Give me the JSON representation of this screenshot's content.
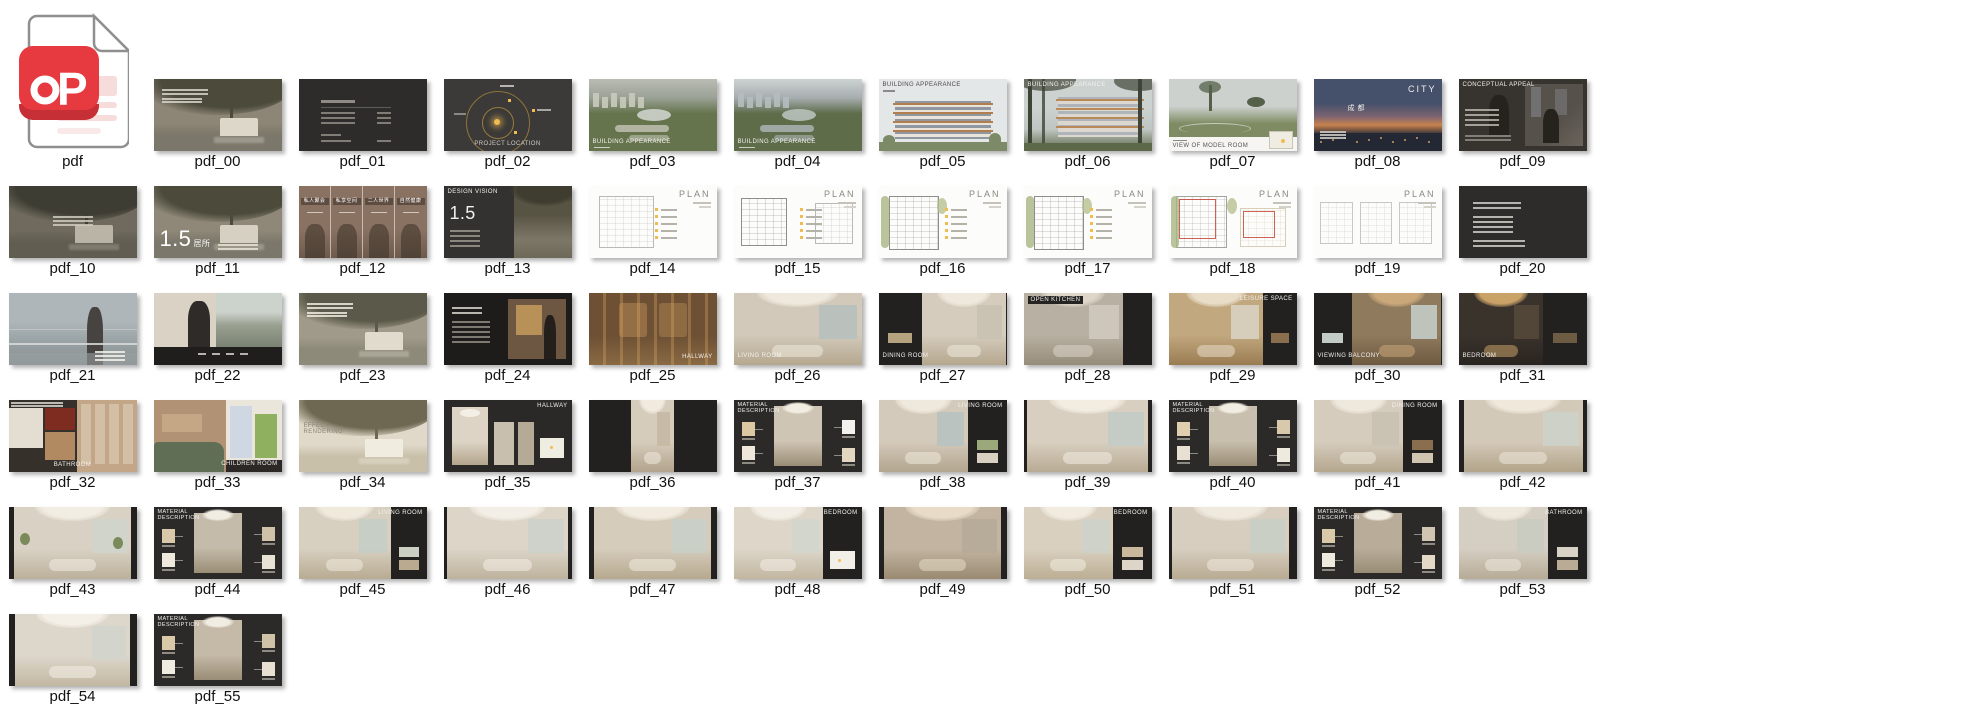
{
  "page": {
    "background": "#ffffff"
  },
  "file_icon": {
    "label": "pdf",
    "glyph": "P",
    "badge_color": "#e63a40",
    "badge_shade": "#c52f35",
    "page_line_color": "#f7dcdc",
    "outline_color": "#8f8f8f"
  },
  "grid": {
    "columns": 11,
    "thumbnails": [
      {
        "label": "pdf_00",
        "kind": "cover",
        "p": {
          "base": "#8d8575",
          "canopy": "#4b4a3b",
          "water": "#7b776a",
          "bld": "#dcd7c9",
          "txt": "#d8d4c8"
        }
      },
      {
        "label": "pdf_01",
        "kind": "toc",
        "variant": "catalog",
        "p": {
          "bg": "#2d2c2b",
          "txt": "#8f8b84"
        }
      },
      {
        "label": "pdf_02",
        "kind": "map",
        "caption": "PROJECT LOCATION",
        "cpos": "bc",
        "ccolor": "#cfccc6",
        "p": {
          "bg": "#3b3a38",
          "ring": "#a5823c",
          "dot": "#f0bc52"
        }
      },
      {
        "label": "pdf_03",
        "kind": "aerial",
        "caption": "BUILDING APPEARANCE",
        "cpos": "bl",
        "p": {
          "sky": "#b9bdb4",
          "far": "#9aa195",
          "green": "#65744d",
          "lake": "#cdd3cb",
          "bld": "#c9cabc"
        }
      },
      {
        "label": "pdf_04",
        "kind": "aerial",
        "caption": "BUILDING APPEARANCE",
        "cpos": "bl",
        "p": {
          "sky": "#cdd3d2",
          "far": "#a8aeb0",
          "green": "#5e6c4a",
          "lake": "#b9c2bd",
          "bld": "#b5bcc0"
        }
      },
      {
        "label": "pdf_05",
        "kind": "elevation",
        "caption": "BUILDING APPEARANCE",
        "cpos": "tl",
        "ccolor": "#4a4a48",
        "p": {
          "sky": "#e4e7e8",
          "bld": "#9097a0",
          "wood": "#b27e4e",
          "green": "#7d8a68"
        }
      },
      {
        "label": "pdf_06",
        "kind": "treesbld",
        "caption": "BUILDING APPEARANCE",
        "cpos": "tl",
        "p": {
          "sky": "#ccd2d0",
          "bld": "#aeb4ba",
          "wood": "#b98a58",
          "tree": "#3f4438",
          "green": "#5c6848"
        }
      },
      {
        "label": "pdf_07",
        "kind": "park",
        "caption": "VIEW OF MODEL ROOM",
        "ccolor": "#55534e",
        "p": {
          "sky": "#ccd1ce",
          "field": "#7f8c63",
          "tree": "#55604a",
          "strip": "#f6f5f2"
        }
      },
      {
        "label": "pdf_08",
        "kind": "dusk",
        "caption": "CITY",
        "cn": "成都",
        "p": {
          "top": "#45506a",
          "mid": "#7c6470",
          "horizon": "#c8824e",
          "land": "#232834"
        }
      },
      {
        "label": "pdf_09",
        "kind": "conceptual",
        "caption": "CONCEPTUAL APPEAL",
        "cpos": "tl",
        "p": {
          "bg": "#37332e",
          "photo": "#56514a",
          "win": "#8d9298"
        }
      },
      {
        "label": "pdf_10",
        "kind": "cover",
        "centered": true,
        "p": {
          "base": "#6f6a5d",
          "canopy": "#3e3d33",
          "water": "#615d51",
          "bld": "#b9b4a5",
          "txt": "#cfcabc"
        }
      },
      {
        "label": "pdf_11",
        "kind": "bignum",
        "big": "1.5",
        "small": "居所",
        "p": {
          "base": "#8f8878",
          "canopy": "#4b4a3b",
          "water": "#7b776a",
          "bld": "#d5d0c2"
        }
      },
      {
        "label": "pdf_12",
        "kind": "people",
        "labels": [
          "私人聚会",
          "私享空间",
          "二人世界",
          "自然健康"
        ],
        "p": {
          "base": "#8a7263",
          "dark": "#3a2f28"
        }
      },
      {
        "label": "pdf_13",
        "kind": "vision",
        "caption": "DESIGN VISION",
        "big": "1.5",
        "p": {
          "left": "#343230",
          "tree": "#585444",
          "base": "#7d7768"
        }
      },
      {
        "label": "pdf_14",
        "kind": "plan",
        "caption": "PLAN",
        "legend": true,
        "plans": [
          {
            "x": 8,
            "y": 14,
            "w": 42,
            "h": 70,
            "c": "#b9b9b6"
          }
        ]
      },
      {
        "label": "pdf_15",
        "kind": "plan",
        "caption": "PLAN",
        "legend": true,
        "plans": [
          {
            "x": 6,
            "y": 16,
            "w": 34,
            "h": 64,
            "c": "#8f8d88"
          },
          {
            "x": 64,
            "y": 24,
            "w": 28,
            "h": 54,
            "c": "#b9b9b6"
          }
        ]
      },
      {
        "label": "pdf_16",
        "kind": "plan",
        "caption": "PLAN",
        "legend": true,
        "green": true,
        "plans": [
          {
            "x": 8,
            "y": 14,
            "w": 38,
            "h": 72,
            "c": "#8f8d88"
          }
        ]
      },
      {
        "label": "pdf_17",
        "kind": "plan",
        "caption": "PLAN",
        "legend": true,
        "green": true,
        "plans": [
          {
            "x": 8,
            "y": 14,
            "w": 38,
            "h": 72,
            "c": "#8f8d88"
          }
        ]
      },
      {
        "label": "pdf_18",
        "kind": "plan",
        "caption": "PLAN",
        "red": true,
        "green": true,
        "plans": [
          {
            "x": 6,
            "y": 14,
            "w": 38,
            "h": 70,
            "c": "#a5a3a0"
          },
          {
            "x": 56,
            "y": 30,
            "w": 34,
            "h": 52,
            "c": "#d9cfb8"
          }
        ]
      },
      {
        "label": "pdf_19",
        "kind": "plan",
        "caption": "PLAN",
        "plans": [
          {
            "x": 5,
            "y": 22,
            "w": 24,
            "h": 56,
            "c": "#c9c7c3"
          },
          {
            "x": 36,
            "y": 22,
            "w": 24,
            "h": 56,
            "c": "#c9c7c3"
          },
          {
            "x": 67,
            "y": 22,
            "w": 24,
            "h": 56,
            "c": "#c9c7c3"
          }
        ]
      },
      {
        "label": "pdf_20",
        "kind": "toc",
        "variant": "notes",
        "p": {
          "bg": "#2d2c2b",
          "txt": "#cfccc6"
        }
      },
      {
        "label": "pdf_21",
        "kind": "balcony",
        "p": {
          "sky": "#aeb6ba",
          "sea": "#97a0a2",
          "fig": "#474340",
          "rail": "#d8dbd8"
        }
      },
      {
        "label": "pdf_22",
        "kind": "suit",
        "p": {
          "l": "#d9d2c5",
          "fig": "#2f2b28",
          "r": "#99a090",
          "sky": "#ccd2cc",
          "strip": "#201e1c"
        }
      },
      {
        "label": "pdf_23",
        "kind": "cover",
        "p": {
          "base": "#a09a8a",
          "canopy": "#5b5949",
          "water": "#8e8a7a",
          "bld": "#e0dbcd",
          "txt": "#efeade"
        }
      },
      {
        "label": "pdf_24",
        "kind": "darkperson",
        "p": {
          "bg": "#1e1c1a",
          "photo": "#6e5742",
          "art": "#c9a05e",
          "fig": "#241f1b"
        }
      },
      {
        "label": "pdf_25",
        "kind": "hallway",
        "caption": "HALLWAY",
        "cpos": "br",
        "p": {
          "base": "#6e5134",
          "slit": "#dca868",
          "floor": "#8a6a44"
        }
      },
      {
        "label": "pdf_26",
        "kind": "room",
        "caption": "LIVING ROOM",
        "cpos": "bl",
        "edges": [
          0,
          0
        ],
        "p": {
          "base": "#d2c9ba",
          "ceil": "#efe9dd",
          "floor": "#b5a890",
          "win": "#b7c0bd"
        }
      },
      {
        "label": "pdf_27",
        "kind": "room",
        "caption": "DINING ROOM",
        "cpos": "bl",
        "edges": [
          34,
          0
        ],
        "chips": [
          "#b5a27e"
        ],
        "p": {
          "base": "#d5ccbd",
          "ceil": "#efe9dd",
          "floor": "#b5a78e",
          "win": "#c9c2b2"
        }
      },
      {
        "label": "pdf_28",
        "kind": "room",
        "caption": "OPEN KITCHEN",
        "cpos": "tl",
        "capbg": "#262422",
        "edges": [
          0,
          22
        ],
        "p": {
          "base": "#b8b0a2",
          "ceil": "#ddd6c9",
          "floor": "#968c7a",
          "win": "#cfc9bc"
        }
      },
      {
        "label": "pdf_29",
        "kind": "room",
        "caption": "LEISURE SPACE",
        "cpos": "tr",
        "edges": [
          0,
          26
        ],
        "chips": [
          "#8a6f4e"
        ],
        "p": {
          "base": "#c2a87f",
          "ceil": "#e9ddc8",
          "floor": "#9a7c52",
          "win": "#d8d2c2"
        }
      },
      {
        "label": "pdf_30",
        "kind": "room",
        "caption": "VIEWING BALCONY",
        "cpos": "bl",
        "edges": [
          30,
          0
        ],
        "chips": [
          "#c3cbc6"
        ],
        "p": {
          "base": "#8f7a5e",
          "ceil": "#caa87a",
          "floor": "#6e5a40",
          "win": "#c3cbc6"
        }
      },
      {
        "label": "pdf_31",
        "kind": "room",
        "caption": "BEDROOM",
        "cpos": "bl",
        "edges": [
          0,
          34
        ],
        "chips": [
          "#6e5b44"
        ],
        "p": {
          "base": "#3a332c",
          "ceil": "#c9a268",
          "floor": "#2a2420",
          "win": "#55483a"
        }
      },
      {
        "label": "pdf_32",
        "kind": "bathcol",
        "caption": "BATHROOM",
        "cpos": "bc",
        "p": {
          "a": "#e3ddd2",
          "red": "#7e2c20",
          "wood": "#b28a62",
          "ward": "#c2a687",
          "dark": "#35302a"
        }
      },
      {
        "label": "pdf_33",
        "kind": "children",
        "caption": "CHILDREN ROOM",
        "cpos": "br",
        "p": {
          "wall": "#b29274",
          "bed": "#5f6e55",
          "panel": "#eae6dc",
          "poster": "#8fb05e",
          "floral": "#cfd8e2"
        }
      },
      {
        "label": "pdf_34",
        "kind": "cover",
        "caption": "EFFECT RENDERING",
        "cpos": "cl",
        "ccolor": "#8a8578",
        "p": {
          "base": "#e0d9c9",
          "canopy": "#6e6852",
          "water": "#c9c0a9",
          "bld": "#f0ece0",
          "txt": "#b5ad9a"
        }
      },
      {
        "label": "pdf_35",
        "kind": "panels",
        "caption": "HALLWAY",
        "cpos": "tr",
        "p": {
          "bg": "#2b2928",
          "p1": "#ddd4c5",
          "p2": "#c9bfae",
          "p3": "#b5aa96"
        }
      },
      {
        "label": "pdf_36",
        "kind": "room",
        "edges": [
          33,
          33
        ],
        "p": {
          "base": "#d6ccbc",
          "ceil": "#f0eadf",
          "floor": "#b2a48c",
          "win": "#c5b9a4"
        }
      },
      {
        "label": "pdf_37",
        "kind": "material",
        "caption": "MATERIAL DESCRIPTION",
        "p": {
          "bg": "#2b2a29",
          "photo": "#cfc5b4",
          "sw": [
            "#dcc9a4",
            "#efe8da",
            "#f4f2ec",
            "#e3d7c2"
          ]
        }
      },
      {
        "label": "pdf_38",
        "kind": "room",
        "caption": "LIVING ROOM",
        "cpos": "tr",
        "edges": [
          0,
          30
        ],
        "chips": [
          "#9aa87a",
          "#d8d0c0"
        ],
        "p": {
          "base": "#d4cabb",
          "ceil": "#efe9dd",
          "floor": "#b3a58e",
          "win": "#b7c2c0"
        }
      },
      {
        "label": "pdf_39",
        "kind": "room",
        "edges": [
          3,
          3
        ],
        "p": {
          "base": "#d8cfc0",
          "ceil": "#f2ece1",
          "floor": "#b9ab94",
          "win": "#c3cbc6"
        }
      },
      {
        "label": "pdf_40",
        "kind": "material",
        "caption": "MATERIAL DESCRIPTION",
        "p": {
          "bg": "#2b2a29",
          "photo": "#c9bfae",
          "sw": [
            "#e0cfae",
            "#e8e0d2",
            "#d9c9ac",
            "#efeade"
          ]
        }
      },
      {
        "label": "pdf_41",
        "kind": "room",
        "caption": "DINING ROOM",
        "cpos": "tr",
        "edges": [
          0,
          30
        ],
        "chips": [
          "#8a6f4e",
          "#cfc5b0"
        ],
        "p": {
          "base": "#d5ccbd",
          "ceil": "#efe9dd",
          "floor": "#b5a78e",
          "win": "#c9c2b2"
        }
      },
      {
        "label": "pdf_42",
        "kind": "room",
        "edges": [
          4,
          3
        ],
        "p": {
          "base": "#d3c9b8",
          "ceil": "#efe8db",
          "floor": "#b2a48a",
          "win": "#cdd2c9"
        }
      },
      {
        "label": "pdf_43",
        "kind": "room",
        "edges": [
          4,
          4
        ],
        "plants": true,
        "p": {
          "base": "#d9d2c4",
          "ceil": "#f2ede3",
          "floor": "#bcb09a",
          "win": "#cfd4cb"
        }
      },
      {
        "label": "pdf_44",
        "kind": "material",
        "caption": "MATERIAL DESCRIPTION",
        "p": {
          "bg": "#2b2a29",
          "photo": "#c5bbaa",
          "sw": [
            "#d9c9a8",
            "#efe9dd",
            "#cfc2a8",
            "#e8e2d4"
          ]
        }
      },
      {
        "label": "pdf_45",
        "kind": "room",
        "caption": "LIVING ROOM",
        "cpos": "tr",
        "edges": [
          0,
          28
        ],
        "chips": [
          "#c9cfc2",
          "#b9aa90"
        ],
        "p": {
          "base": "#d7cfc0",
          "ceil": "#f0eadd",
          "floor": "#b9ab92",
          "win": "#c5cdc6"
        }
      },
      {
        "label": "pdf_46",
        "kind": "room",
        "edges": [
          3,
          3
        ],
        "p": {
          "base": "#dcd5c8",
          "ceil": "#f4efe6",
          "floor": "#beb29c",
          "win": "#ccd2ca"
        }
      },
      {
        "label": "pdf_47",
        "kind": "room",
        "edges": [
          4,
          4
        ],
        "p": {
          "base": "#d5ccbc",
          "ceil": "#f2ece0",
          "floor": "#b7a98f",
          "win": "#c9cfc8"
        }
      },
      {
        "label": "pdf_48",
        "kind": "room",
        "caption": "BEDROOM",
        "cpos": "tr",
        "edges": [
          0,
          30
        ],
        "planchip": true,
        "p": {
          "base": "#ddd6c9",
          "ceil": "#f4efe6",
          "floor": "#c2b6a0",
          "win": "#d2d6cd"
        }
      },
      {
        "label": "pdf_49",
        "kind": "room",
        "edges": [
          4,
          4
        ],
        "p": {
          "base": "#c2b4a0",
          "ceil": "#e8dcc8",
          "floor": "#9a8a72",
          "win": "#b5ab98"
        }
      },
      {
        "label": "pdf_50",
        "kind": "room",
        "caption": "BEDROOM",
        "cpos": "tr",
        "edges": [
          0,
          30
        ],
        "chips": [
          "#c9b89c",
          "#ddd6c8"
        ],
        "p": {
          "base": "#d9d0c0",
          "ceil": "#f2ece0",
          "floor": "#bcae94",
          "win": "#cdd2ca"
        }
      },
      {
        "label": "pdf_51",
        "kind": "room",
        "edges": [
          3,
          6
        ],
        "p": {
          "base": "#d7cec0",
          "ceil": "#f0eade",
          "floor": "#b9ab92",
          "win": "#c9cfc6"
        }
      },
      {
        "label": "pdf_52",
        "kind": "material",
        "caption": "MATERIAL DESCRIPTION",
        "p": {
          "bg": "#2b2a29",
          "photo": "#b9ad9a",
          "sw": [
            "#d9c9a8",
            "#efeade",
            "#cfc5b0",
            "#e3d9c6"
          ]
        }
      },
      {
        "label": "pdf_53",
        "kind": "room",
        "caption": "BATHROOM",
        "cpos": "tr",
        "edges": [
          0,
          30
        ],
        "chips": [
          "#d8d2c6",
          "#b9ab94"
        ],
        "p": {
          "base": "#d5cec2",
          "ceil": "#efe9dd",
          "floor": "#b7ab96",
          "win": "#c9ccc2"
        }
      },
      {
        "label": "pdf_54",
        "kind": "room",
        "edges": [
          5,
          5
        ],
        "p": {
          "base": "#ddd6ca",
          "ceil": "#f4f0e8",
          "floor": "#c2b7a2",
          "win": "#d2d5cc"
        }
      },
      {
        "label": "pdf_55",
        "kind": "material",
        "caption": "MATERIAL DESCRIPTION",
        "p": {
          "bg": "#2b2a29",
          "photo": "#c5baa8",
          "sw": [
            "#d9c9a8",
            "#f0ece2",
            "#cfc2a6",
            "#e8e0d0"
          ]
        }
      },
      {
        "label": "pdf_56",
        "kind": "photogrid",
        "p": {
          "bg": "#2b2928",
          "t": [
            "#d9d0c0",
            "#cfc5b2",
            "#c5b9a4",
            "#ddd5c6",
            "#c9bfae",
            "#d2c9b8"
          ]
        }
      },
      {
        "label": "pdf_57",
        "kind": "toc",
        "variant": "catalog",
        "p": {
          "bg": "#2f2e2d",
          "txt": "#6e6a64"
        }
      },
      {
        "label": "pdf_58",
        "kind": "cover",
        "caption": "FOLDING VILLA LOBBY",
        "cpos": "tl",
        "p": {
          "base": "#6b5f47",
          "canopy": "#433b2c",
          "water": "#59503c",
          "bld": "#c2b294",
          "txt": "#cfc5ae"
        }
      },
      {
        "label": "pdf_59",
        "kind": "plan",
        "caption": "PLAN",
        "red": true,
        "plans": [
          {
            "x": 18,
            "y": 16,
            "w": 44,
            "h": 66,
            "c": "#d9d9d6"
          },
          {
            "x": 68,
            "y": 22,
            "w": 24,
            "h": 54,
            "c": "#e3d9c2"
          }
        ]
      },
      {
        "label": "pdf_60",
        "kind": "darkstone",
        "p": {
          "bg": "#262422",
          "stone": "#6e6658",
          "txt": "#b5b0a8"
        }
      },
      {
        "label": "pdf_61",
        "kind": "plan",
        "caption": "PLAN",
        "plans": [
          {
            "x": 12,
            "y": 26,
            "w": 30,
            "h": 48,
            "c": "#8a8780"
          },
          {
            "x": 52,
            "y": 20,
            "w": 36,
            "h": 58,
            "c": "#d9d2c2"
          }
        ]
      },
      {
        "label": "pdf_62",
        "kind": "goldlobby",
        "p": {
          "bg": "#26211b",
          "door": "#d9cfc0",
          "gold": "#a87c3e",
          "fig": "#332b22"
        }
      },
      {
        "label": "pdf_63",
        "kind": "room",
        "caption": "UNDERGROUND LOBBY",
        "cpos": "bl",
        "edges": [
          0,
          0
        ],
        "p": {
          "base": "#8a6f4e",
          "ceil": "#c9a26a",
          "floor": "#5f4a30",
          "win": "#d9c9a8"
        }
      },
      {
        "label": "pdf_64",
        "kind": "room",
        "caption": "UNDERGROUND LOBBY",
        "cpos": "tc",
        "edges": [
          5,
          5
        ],
        "p": {
          "base": "#4a4038",
          "ceil": "#b08a56",
          "floor": "#332b22",
          "win": "#6e5f4c"
        }
      }
    ]
  },
  "cutoff_row": {
    "present": true
  }
}
